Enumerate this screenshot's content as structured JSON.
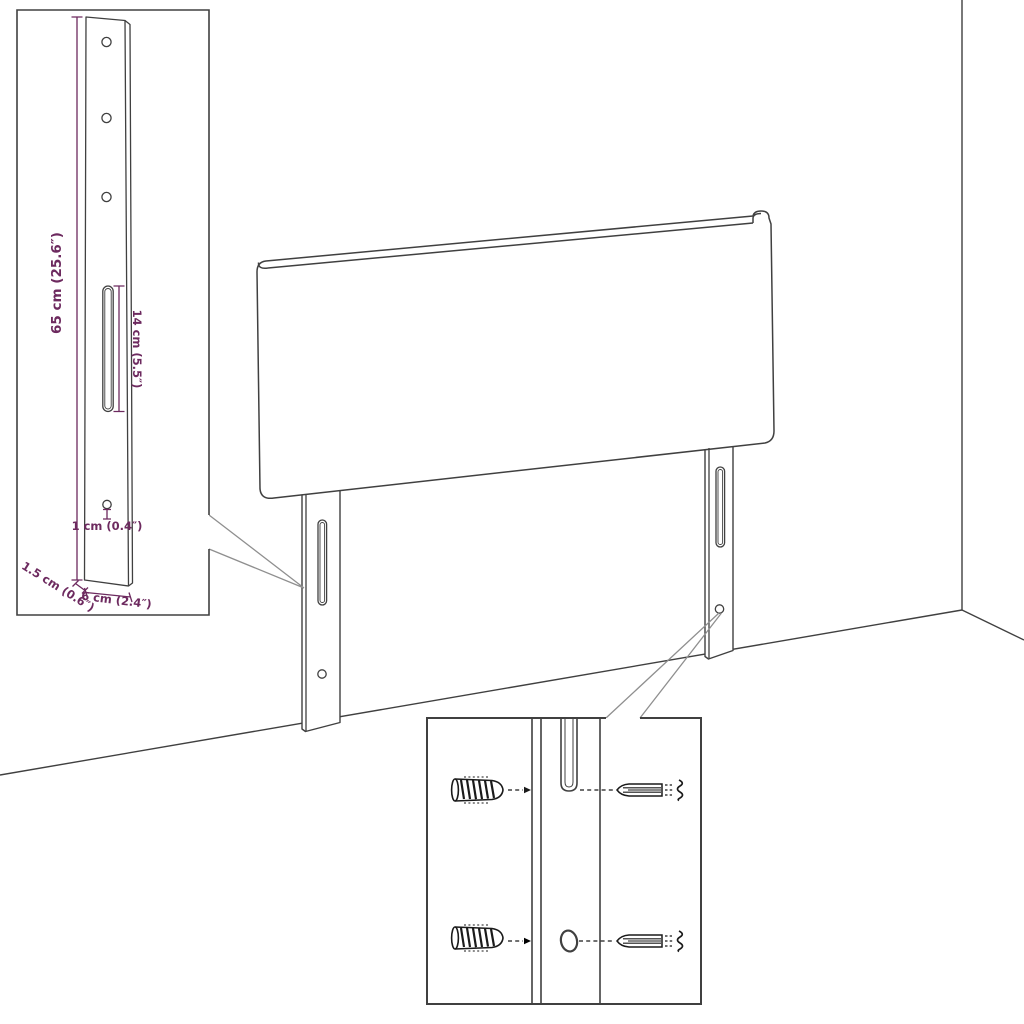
{
  "document": {
    "type": "product-dimension-diagram",
    "subject": "headboard with two wall-mount legs shown in a room corner, with a leg dimension inset and a screw/wall-plug mounting inset"
  },
  "colors": {
    "background": "#ffffff",
    "line": "#404040",
    "hardware": "#1a1a1a",
    "callout": "#8f8f8f",
    "dimension": "#6d2a5f"
  },
  "dimensions": {
    "height": "65 cm (25.6″)",
    "slot_length": "14 cm (5.5″)",
    "hole_diameter": "1 cm (0.4″)",
    "thickness": "1.5 cm (0.6″)",
    "width": "6 cm (2.4″)"
  }
}
